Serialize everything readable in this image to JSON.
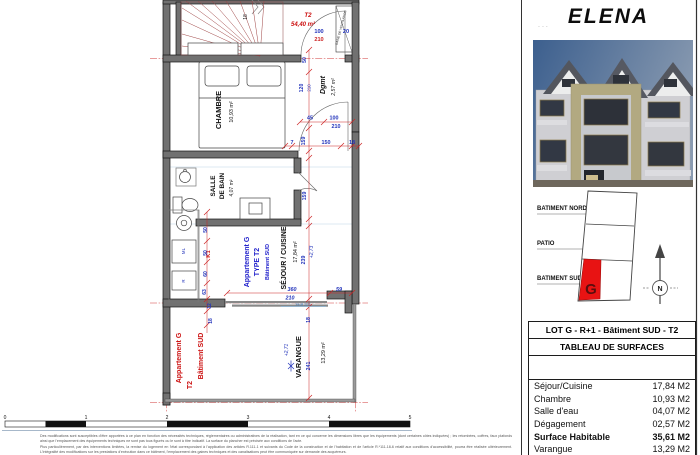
{
  "title": "ELENA",
  "artifact_dots": "...",
  "plan": {
    "type_label": "T2",
    "total_area": "54,40 m²",
    "gaine": "GAINE DE VENTILATION",
    "stair_risers": "18",
    "rooms": {
      "chambre": {
        "name": "CHAMBRE",
        "area": "10,93 m²"
      },
      "sdb_l1": "SALLE",
      "sdb_l2": "DE BAIN",
      "sdb_area": "4,07 m²",
      "dgmt": {
        "name": "Dgmt",
        "area": "2,57 m²"
      },
      "sejour": {
        "name": "SÉJOUR / CUISINE",
        "area": "17,84 m²"
      },
      "varangue": {
        "name": "VARANGUE",
        "area": "13,29 m²"
      }
    },
    "apt_blue": {
      "l1": "Appartement G",
      "l2": "TYPE T2",
      "l3": "Bâtiment  SUD"
    },
    "apt_red": {
      "l1": "Appartement G",
      "l2": "T2",
      "l3": "Bâtiment  SUD"
    },
    "labels": {
      "k1": "K1",
      "ml": "ML",
      "r": "R",
      "seuil": "Seuil 2cm"
    },
    "levels": {
      "sejour": "+2,73",
      "varangue": "+2,71"
    },
    "dims": {
      "door_w": "100",
      "door_h": "210",
      "d20": "20",
      "d50": "50",
      "d120": "120",
      "d210a": "210",
      "d45": "45",
      "w2_100": "100",
      "w2_210": "210",
      "d7": "7",
      "d159a": "159",
      "d150": "150",
      "d18a": "18",
      "d159b": "159",
      "d239": "239",
      "k50a": "50",
      "k50b": "50",
      "k60": "60",
      "k63": "63",
      "k12": "12",
      "k18": "18",
      "bay_w": "360",
      "bay_h": "210",
      "d59": "59",
      "v241": "241",
      "v18": "18"
    }
  },
  "keyplan": {
    "nord": "BATIMENT NORD",
    "patio": "PATIO",
    "sud": "BATIMENT SUD",
    "lot": "G",
    "north": "N"
  },
  "table": {
    "header1": "LOT G - R+1 - Bâtiment SUD - T2",
    "header2": "TABLEAU DE SURFACES",
    "rows": [
      {
        "label": "Séjour/Cuisine",
        "value": "17,84 M2"
      },
      {
        "label": "Chambre",
        "value": "10,93 M2"
      },
      {
        "label": "Salle d'eau",
        "value": "04,07 M2"
      },
      {
        "label": "Dégagement",
        "value": "02,57 M2"
      },
      {
        "label": "Surface Habitable",
        "value": "35,61 M2"
      },
      {
        "label": "Varangue",
        "value": "13,29 M2"
      },
      {
        "label": "Total",
        "value": "48,90 M2"
      }
    ]
  },
  "scale": {
    "labels": [
      "0",
      "1",
      "2",
      "3",
      "4",
      "5"
    ]
  },
  "disclaimer": {
    "p1": "Des modifications sont susceptibles d'être apportées à ce plan en fonction des nécessités techniques, réglementaires ou administratives de la réalisation, tant en ce qui concerne les dimensions libres que les équipements (dont certaines côtes indiquées) ; les retombées, coffres, faux plafonds ainsi que l'emplacement des équipements techniques ne sont pas tous figurés ou le sont à titre indicatif. La surface du plancher est précisée aux conditions de l'acte.",
    "p2": "Plus particulièrement, par des interventions limitées, la remise du logement en l'état correspondant à l'application des articles R.111-1 et suivants du Code de la construction et de l'habitation et de l'article R.*111-18-6 relatif aux conditions d'accessibilité, pourra être réalisée ultérieurement. L'intégralité des modifications sur les prestations d'exécution dans ce bâtiment, l'emplacement des gaines techniques et des canalisations peut être communiquée sur demande des acquéreurs."
  }
}
